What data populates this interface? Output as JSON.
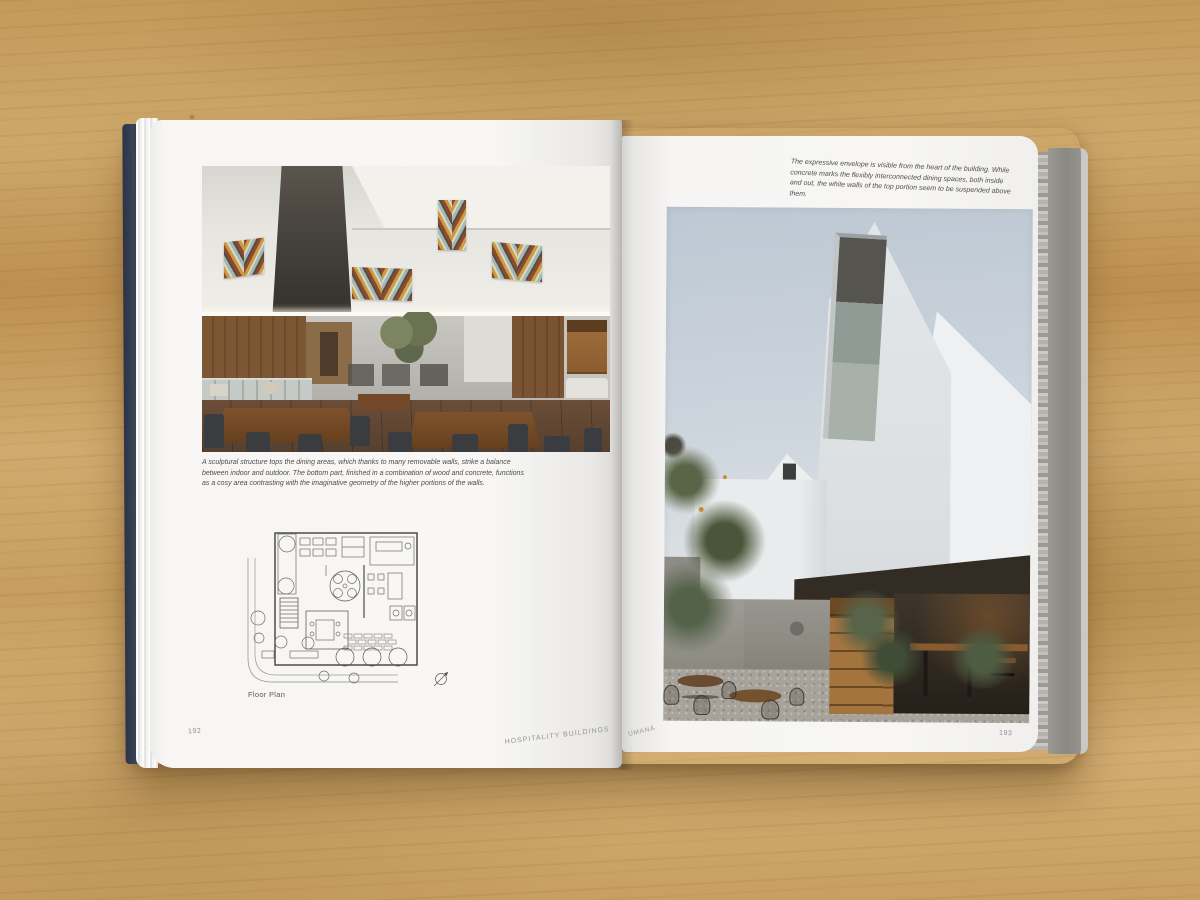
{
  "book": {
    "left_page": {
      "photo_caption": "A sculptural structure tops the dining areas, which thanks to many removable walls, strike a balance between indoor and outdoor. The bottom part, finished in a combination of wood and concrete, functions as a cosy area contrasting with the imaginative geometry of the higher portions of the walls.",
      "plan_label": "Floor Plan",
      "page_number": "192",
      "section_title": "HOSPITALITY BUILDINGS"
    },
    "right_page": {
      "photo_caption": "The expressive envelope is visible from the heart of the building. While concrete marks the flexibly interconnected dining spaces, both inside and out, the white walls of the top portion seem to be suspended above them.",
      "project_name": "UMANÁ",
      "page_number": "193"
    }
  },
  "colors": {
    "wood_table": "#c79f62",
    "page_white": "#f6f5f3",
    "front_cover_edge": "#3a4156",
    "back_cover_edge": "#8f8d89",
    "caption_text": "#4d4d4d",
    "footer_text": "#8f8f8f",
    "chevron_rust": "#8a4a33",
    "chevron_ochre": "#c99c41",
    "chevron_blue": "#9db9ba"
  }
}
